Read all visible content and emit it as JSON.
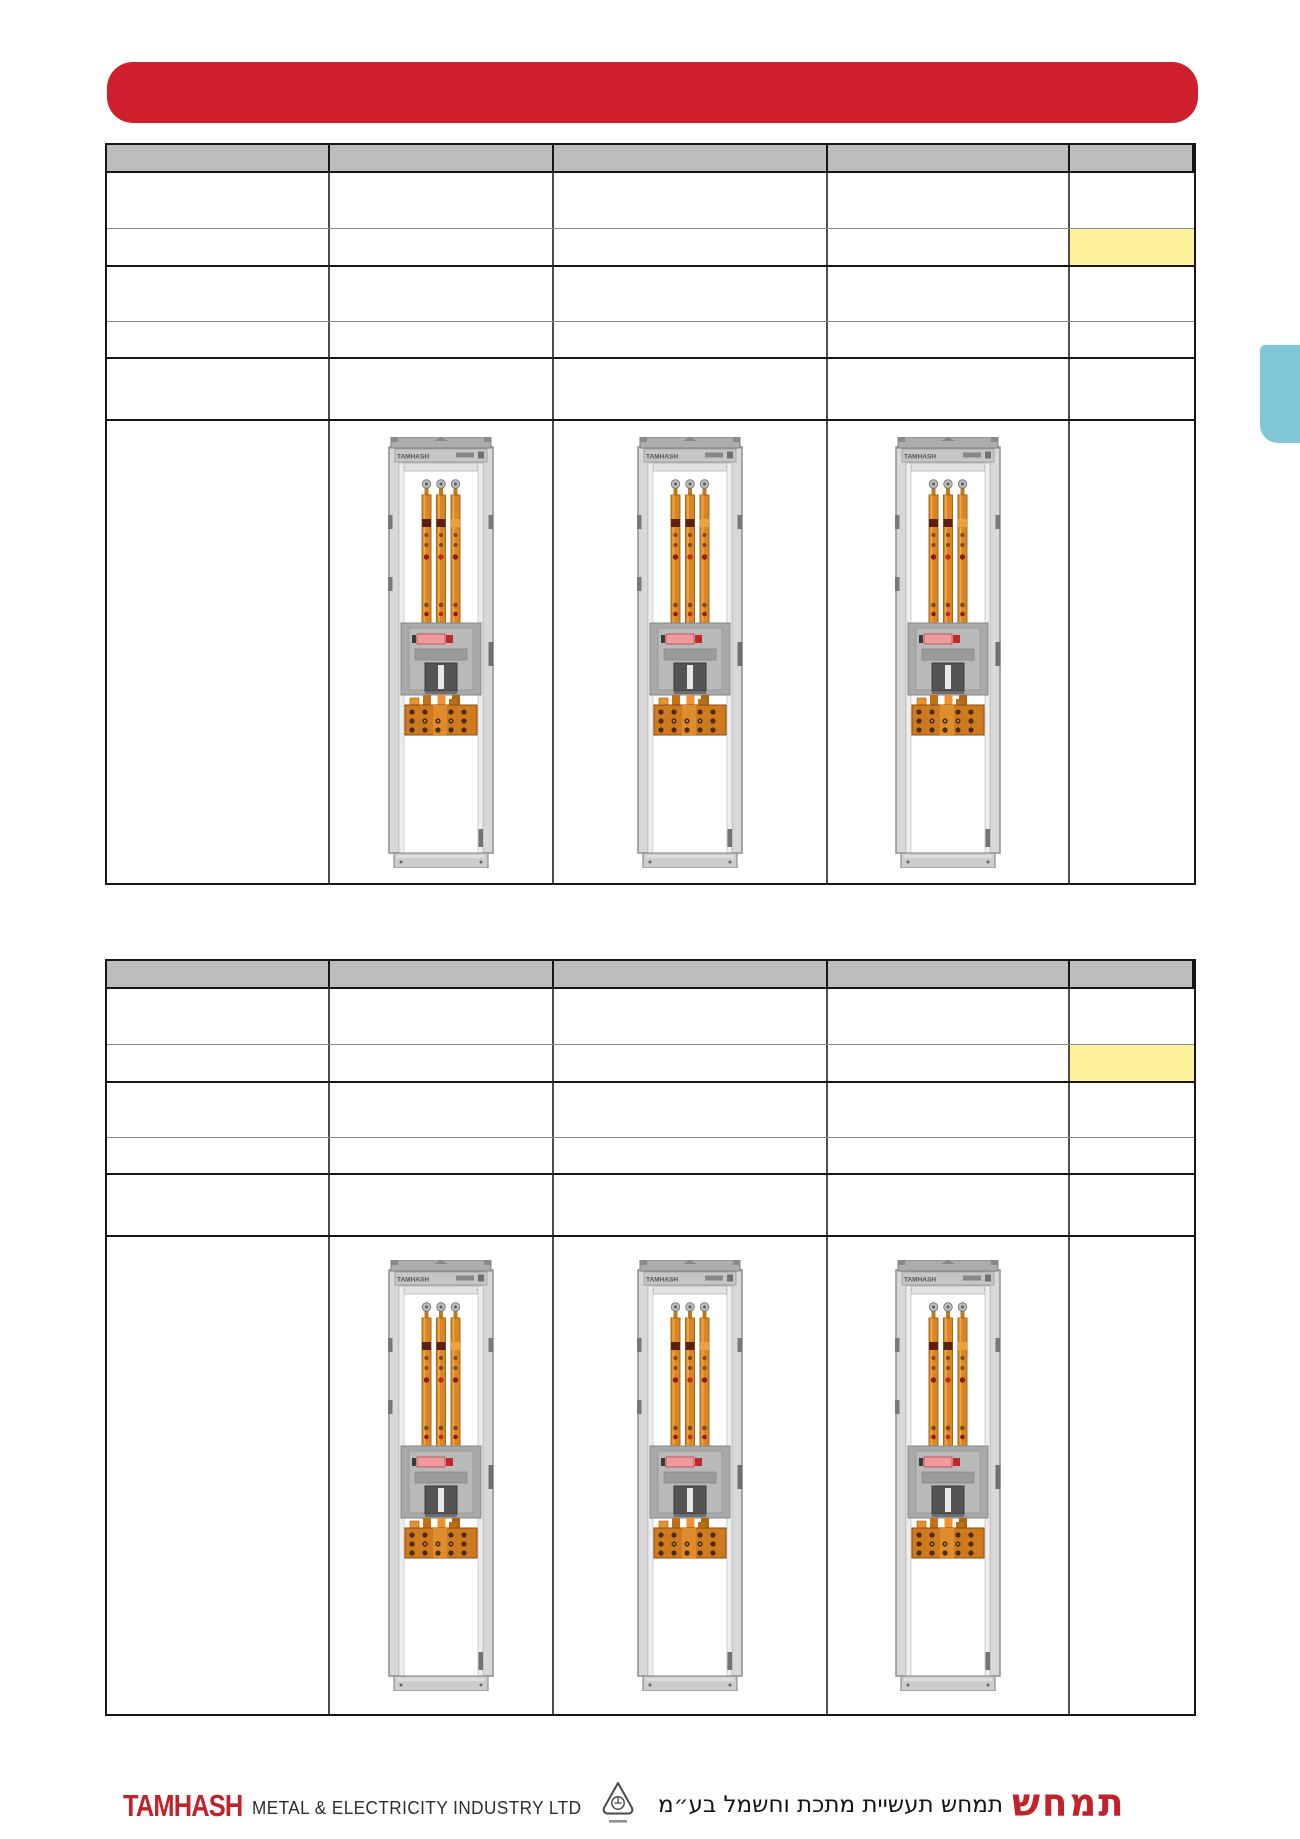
{
  "banner": {
    "label": "",
    "color": "#cf1f2c"
  },
  "side_tab": {
    "color": "#80c8d8"
  },
  "table_top": {
    "header": {
      "bg": "#bdbdbd",
      "cells": [
        "",
        "",
        "",
        "",
        ""
      ]
    },
    "rows": [
      {
        "cells": [
          "",
          "",
          "",
          "",
          ""
        ]
      },
      {
        "cells": [
          "",
          "",
          "",
          "",
          ""
        ],
        "highlighted_cell": 4,
        "highlight_color": "#fbf299"
      },
      {
        "cells": [
          "",
          "",
          "",
          "",
          ""
        ]
      },
      {
        "cells": [
          "",
          "",
          "",
          "",
          ""
        ]
      },
      {
        "cells": [
          "",
          "",
          "",
          "",
          ""
        ]
      }
    ],
    "image_row": {
      "cabinet_count": 3
    }
  },
  "table_bottom": {
    "header": {
      "bg": "#bdbdbd",
      "cells": [
        "",
        "",
        "",
        "",
        ""
      ]
    },
    "rows": [
      {
        "cells": [
          "",
          "",
          "",
          "",
          ""
        ]
      },
      {
        "cells": [
          "",
          "",
          "",
          "",
          ""
        ],
        "highlighted_cell": 4,
        "highlight_color": "#fbf299"
      },
      {
        "cells": [
          "",
          "",
          "",
          "",
          ""
        ]
      },
      {
        "cells": [
          "",
          "",
          "",
          "",
          ""
        ]
      },
      {
        "cells": [
          "",
          "",
          "",
          "",
          ""
        ]
      }
    ],
    "image_row": {
      "cabinet_count": 3
    }
  },
  "cabinet": {
    "brand_label": "TAMHASH",
    "body_color": "#d8d8d8",
    "busbar_color": "#db8624",
    "terminal_color": "#cf7a1f"
  },
  "footer": {
    "logo_en": "TAMHASH",
    "company_en": "METAL & ELECTRICITY  INDUSTRY  LTD",
    "company_he": "תמחש תעשיית מתכת וחשמל בע״מ",
    "logo_he": "תמחש",
    "logo_color": "#c4222b"
  }
}
